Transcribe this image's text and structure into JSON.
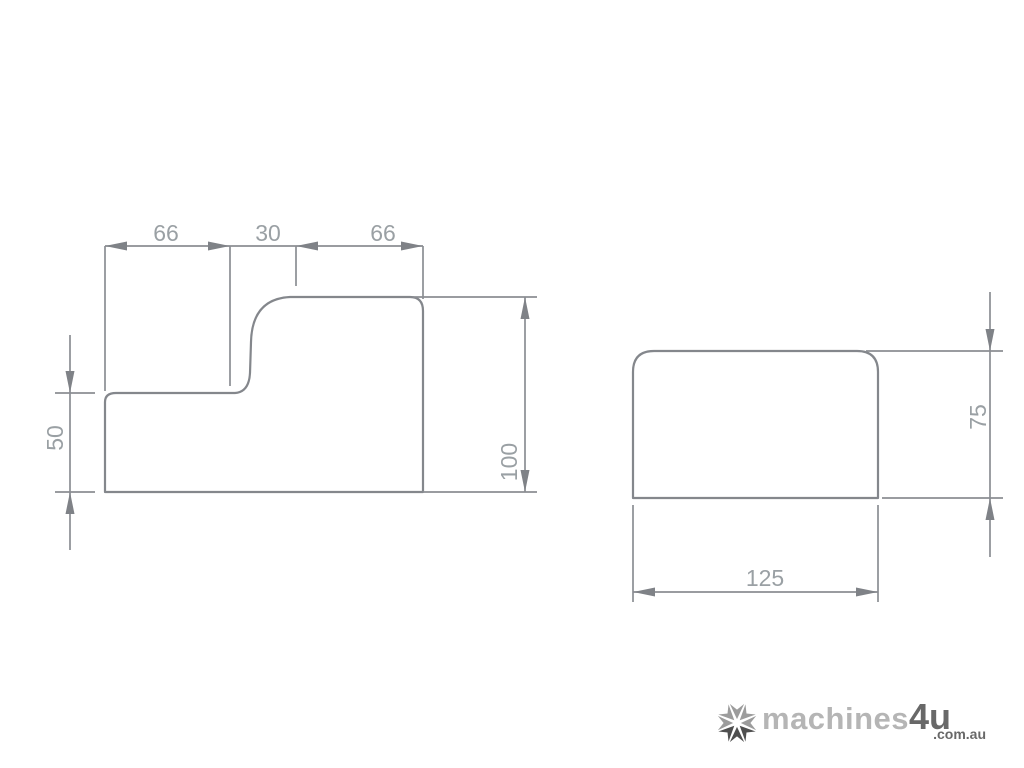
{
  "figure": {
    "type": "technical-drawing",
    "line_color": "#84878c",
    "dim_text_color": "#9aa0a4",
    "left_profile": {
      "description": "stepped block cross-section with ogee transition",
      "dims": {
        "top_segment_1": "66",
        "top_segment_2": "30",
        "top_segment_3": "66",
        "step_height": "50",
        "overall_height": "100"
      }
    },
    "right_profile": {
      "description": "rectangular block cross-section with rounded top corners",
      "dims": {
        "height": "75",
        "width": "125"
      }
    }
  },
  "watermark": {
    "icon": "starburst-icon",
    "brand": "machines",
    "brand_suffix": "4u",
    "tld": ".com.au"
  }
}
